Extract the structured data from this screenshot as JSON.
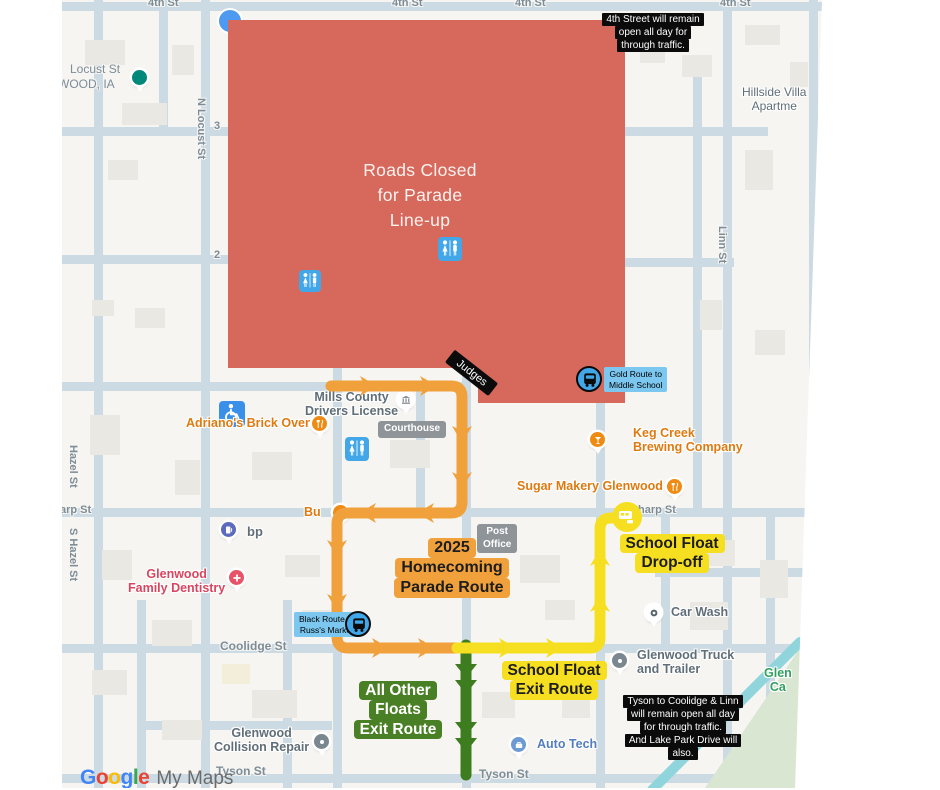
{
  "colors": {
    "parade_orange": "#F0A13C",
    "school_yellow": "#F6DF20",
    "floats_green": "#3E7D1F",
    "closed_red": "#D7695C",
    "badge_blue": "#7CC7EF",
    "bus_circle_blue": "#42A7E8",
    "road": "#CCDAE4",
    "map_bg": "#F6F5F2"
  },
  "red_zone": {
    "lines": [
      "Roads Closed",
      "for Parade",
      "Line-up"
    ]
  },
  "notes": {
    "fourth": {
      "lines": [
        "4th Street will remain",
        "open all day for",
        "through traffic."
      ]
    },
    "tyson": {
      "lines": [
        "Tyson to Coolidge & Linn",
        "will remain open all day",
        "for through traffic.",
        "And Lake Park Drive will",
        "also."
      ]
    }
  },
  "route_labels": {
    "parade": {
      "lines": [
        "2025",
        "Homecoming",
        "Parade Route"
      ]
    },
    "drop_off": {
      "lines": [
        "School Float",
        "Drop-off"
      ]
    },
    "school_exit": {
      "lines": [
        "School Float",
        "Exit Route"
      ]
    },
    "floats_exit": {
      "lines": [
        "All Other",
        "Floats",
        "Exit Route"
      ]
    },
    "judges": "Judges"
  },
  "badges": {
    "gold": {
      "lines": [
        "Gold Route to",
        "Middle School"
      ]
    },
    "black": {
      "lines": [
        "Black Route to",
        "Russ's Market"
      ]
    }
  },
  "streets": {
    "fourth": "4th St",
    "locust_partial": "Locust St",
    "city_partial": "WOOD, IA",
    "n_locust": "N Locust St",
    "num3": "3",
    "num2": "2",
    "hazel": "Hazel St",
    "s_hazel": "S Hazel St",
    "sharp_left": "arp St",
    "sharp_right": "harp St",
    "linn": "Linn St",
    "coolidge": "Coolidge St",
    "tyson": "Tyson St"
  },
  "pois": {
    "hillside": {
      "lines": [
        "Hillside Villa",
        "Apartme"
      ]
    },
    "adrianos": "Adriano's Brick Oven",
    "mills": {
      "lines": [
        "Mills County",
        "Drivers License"
      ]
    },
    "courthouse": "Courthouse",
    "keg": {
      "lines": [
        "Keg Creek",
        "Brewing Company"
      ]
    },
    "sugar": "Sugar Makery Glenwood",
    "post": {
      "lines": [
        "Post",
        "Office"
      ]
    },
    "bp": "bp",
    "bu_partial": "Bu",
    "dentistry": {
      "lines": [
        "Glenwood",
        "Family Dentistry"
      ]
    },
    "car_wash": "Car Wash",
    "truck": {
      "lines": [
        "Glenwood Truck",
        "and Trailer"
      ]
    },
    "collision": {
      "lines": [
        "Glenwood",
        "Collision Repair"
      ]
    },
    "auto_tech": "Auto Tech",
    "park_partial": {
      "lines": [
        "Glen",
        "Ca"
      ]
    }
  },
  "watermark": {
    "letters": [
      "G",
      "o",
      "o",
      "g",
      "l",
      "e"
    ],
    "suffix": "My Maps"
  }
}
